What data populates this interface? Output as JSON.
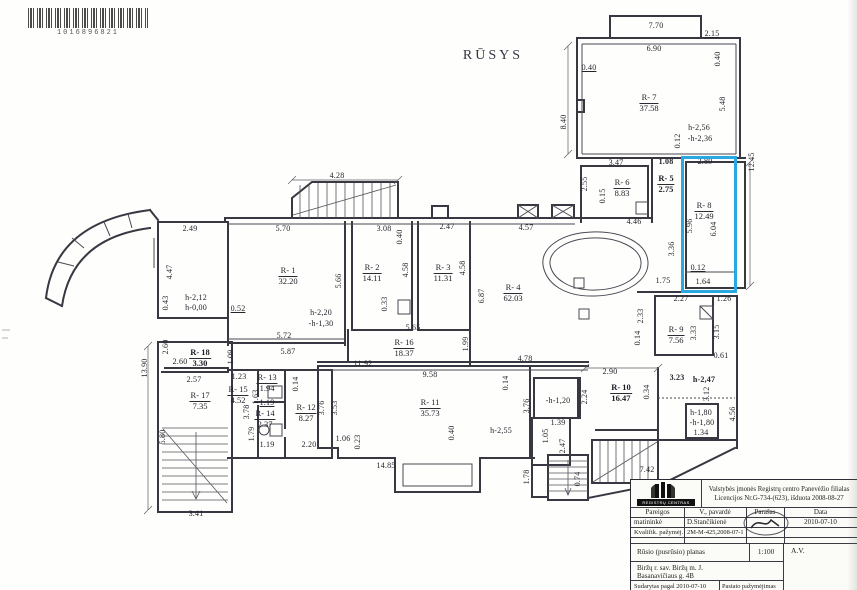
{
  "barcode": {
    "number": "1016896821"
  },
  "plan": {
    "title": "RŪSYS",
    "highlight_color": "#29a8e1",
    "rooms": [
      {
        "id": "R- 1",
        "area": "32.20",
        "x": 288,
        "y": 266
      },
      {
        "id": "R- 2",
        "area": "14.11",
        "x": 372,
        "y": 263
      },
      {
        "id": "R- 3",
        "area": "11.31",
        "x": 443,
        "y": 263
      },
      {
        "id": "R- 4",
        "area": "62.03",
        "x": 513,
        "y": 283
      },
      {
        "id": "R- 5",
        "area": "2.75",
        "x": 666,
        "y": 174,
        "b": 1
      },
      {
        "id": "R- 6",
        "area": "8.83",
        "x": 622,
        "y": 178
      },
      {
        "id": "R- 7",
        "area": "37.58",
        "x": 649,
        "y": 93
      },
      {
        "id": "R- 8",
        "area": "12.49",
        "x": 704,
        "y": 201
      },
      {
        "id": "R- 9",
        "area": "7.56",
        "x": 676,
        "y": 325
      },
      {
        "id": "R- 10",
        "area": "16.47",
        "x": 621,
        "y": 383,
        "b": 1
      },
      {
        "id": "R- 11",
        "area": "35.73",
        "x": 430,
        "y": 398
      },
      {
        "id": "R- 12",
        "area": "8.27",
        "x": 306,
        "y": 403
      },
      {
        "id": "R- 13",
        "area": "1.94",
        "x": 267,
        "y": 373
      },
      {
        "id": "R- 14",
        "area": "2.37",
        "x": 265,
        "y": 409
      },
      {
        "id": "R- 15",
        "area": "4.52",
        "x": 238,
        "y": 385
      },
      {
        "id": "R- 16",
        "area": "18.37",
        "x": 404,
        "y": 338
      },
      {
        "id": "R- 17",
        "area": "7.35",
        "x": 200,
        "y": 391
      },
      {
        "id": "R- 18",
        "area": "3.30",
        "x": 200,
        "y": 348,
        "b": 1
      }
    ],
    "dims": [
      {
        "t": "7.70",
        "x": 656,
        "y": 26
      },
      {
        "t": "6.90",
        "x": 654,
        "y": 49
      },
      {
        "t": "2.15",
        "x": 712,
        "y": 34,
        "u": 1
      },
      {
        "t": "0.40",
        "x": 718,
        "y": 59,
        "v": 1
      },
      {
        "t": "0.40",
        "x": 589,
        "y": 68,
        "u": 1
      },
      {
        "t": "5.48",
        "x": 723,
        "y": 104,
        "v": 1
      },
      {
        "t": "0.12",
        "x": 678,
        "y": 141,
        "v": 1
      },
      {
        "t": "h-2,56",
        "x": 699,
        "y": 128
      },
      {
        "t": "-h-2,36",
        "x": 700,
        "y": 139
      },
      {
        "t": "8.40",
        "x": 564,
        "y": 122,
        "v": 1
      },
      {
        "t": "12.45",
        "x": 752,
        "y": 162,
        "v": 1
      },
      {
        "t": "3.47",
        "x": 616,
        "y": 163
      },
      {
        "t": "1.08",
        "x": 666,
        "y": 162,
        "b": 1
      },
      {
        "t": "2.89",
        "x": 705,
        "y": 162
      },
      {
        "t": "2.55",
        "x": 585,
        "y": 184,
        "v": 1
      },
      {
        "t": "0.15",
        "x": 603,
        "y": 196,
        "v": 1
      },
      {
        "t": "4.46",
        "x": 634,
        "y": 222
      },
      {
        "t": "5.96",
        "x": 690,
        "y": 226,
        "v": 1
      },
      {
        "t": "6.04",
        "x": 714,
        "y": 229,
        "v": 1
      },
      {
        "t": "3.36",
        "x": 672,
        "y": 249,
        "v": 1
      },
      {
        "t": "0.12",
        "x": 698,
        "y": 268,
        "u": 1
      },
      {
        "t": "1.64",
        "x": 703,
        "y": 282
      },
      {
        "t": "1.75",
        "x": 663,
        "y": 281
      },
      {
        "t": "4.28",
        "x": 337,
        "y": 176
      },
      {
        "t": "4.57",
        "x": 526,
        "y": 228
      },
      {
        "t": "2.49",
        "x": 190,
        "y": 229
      },
      {
        "t": "5.70",
        "x": 283,
        "y": 229
      },
      {
        "t": "3.08",
        "x": 384,
        "y": 229
      },
      {
        "t": "0.40",
        "x": 400,
        "y": 237,
        "v": 1
      },
      {
        "t": "2.47",
        "x": 447,
        "y": 227
      },
      {
        "t": "4.47",
        "x": 170,
        "y": 272,
        "v": 1
      },
      {
        "t": "0.43",
        "x": 166,
        "y": 303,
        "v": 1
      },
      {
        "t": "h-2,12",
        "x": 196,
        "y": 298
      },
      {
        "t": "h-0,00",
        "x": 196,
        "y": 308
      },
      {
        "t": "5.66",
        "x": 339,
        "y": 281,
        "v": 1
      },
      {
        "t": "4.58",
        "x": 406,
        "y": 270,
        "v": 1
      },
      {
        "t": "0.33",
        "x": 385,
        "y": 304,
        "v": 1
      },
      {
        "t": "4.58",
        "x": 463,
        "y": 268,
        "v": 1
      },
      {
        "t": "6.87",
        "x": 482,
        "y": 296,
        "v": 1
      },
      {
        "t": "h-2,20",
        "x": 321,
        "y": 313
      },
      {
        "t": "-h-1,30",
        "x": 321,
        "y": 324
      },
      {
        "t": "0.52",
        "x": 238,
        "y": 309,
        "u": 1
      },
      {
        "t": "5.72",
        "x": 284,
        "y": 336
      },
      {
        "t": "5.87",
        "x": 288,
        "y": 352
      },
      {
        "t": "2.60",
        "x": 166,
        "y": 347,
        "v": 1
      },
      {
        "t": "2.60",
        "x": 180,
        "y": 362
      },
      {
        "t": "1.09",
        "x": 231,
        "y": 357,
        "v": 1
      },
      {
        "t": "13.90",
        "x": 145,
        "y": 368,
        "v": 1
      },
      {
        "t": "5.65",
        "x": 413,
        "y": 328
      },
      {
        "t": "1.99",
        "x": 466,
        "y": 344,
        "v": 1
      },
      {
        "t": "11.92",
        "x": 363,
        "y": 364
      },
      {
        "t": "4.78",
        "x": 525,
        "y": 359
      },
      {
        "t": "0.14",
        "x": 638,
        "y": 338,
        "v": 1
      },
      {
        "t": "2.33",
        "x": 641,
        "y": 316,
        "v": 1
      },
      {
        "t": "2.27",
        "x": 681,
        "y": 299
      },
      {
        "t": "1.26",
        "x": 724,
        "y": 299
      },
      {
        "t": "3.33",
        "x": 694,
        "y": 333,
        "v": 1
      },
      {
        "t": "3.15",
        "x": 717,
        "y": 332,
        "v": 1
      },
      {
        "t": "0.61",
        "x": 721,
        "y": 356
      },
      {
        "t": "2.57",
        "x": 194,
        "y": 380
      },
      {
        "t": "1.23",
        "x": 239,
        "y": 377
      },
      {
        "t": "5.80",
        "x": 163,
        "y": 437,
        "v": 1
      },
      {
        "t": "3.41",
        "x": 196,
        "y": 514
      },
      {
        "t": "3.78",
        "x": 247,
        "y": 412,
        "v": 1
      },
      {
        "t": "1.63",
        "x": 256,
        "y": 397,
        "v": 1
      },
      {
        "t": "1.19",
        "x": 267,
        "y": 403,
        "u": 1
      },
      {
        "t": "1.79",
        "x": 252,
        "y": 434,
        "v": 1
      },
      {
        "t": "1.19",
        "x": 267,
        "y": 445
      },
      {
        "t": "0.14",
        "x": 296,
        "y": 384,
        "v": 1
      },
      {
        "t": "3.76",
        "x": 322,
        "y": 408,
        "v": 1
      },
      {
        "t": "2.20",
        "x": 309,
        "y": 445
      },
      {
        "t": "3.53",
        "x": 335,
        "y": 408,
        "v": 1
      },
      {
        "t": "9.58",
        "x": 430,
        "y": 375
      },
      {
        "t": "0.14",
        "x": 506,
        "y": 383,
        "v": 1
      },
      {
        "t": "3.76",
        "x": 527,
        "y": 406,
        "v": 1
      },
      {
        "t": "1.06",
        "x": 343,
        "y": 439
      },
      {
        "t": "0.23",
        "x": 358,
        "y": 442,
        "v": 1
      },
      {
        "t": "0.40",
        "x": 452,
        "y": 433,
        "v": 1
      },
      {
        "t": "h-2,55",
        "x": 501,
        "y": 431
      },
      {
        "t": "14.85",
        "x": 386,
        "y": 466
      },
      {
        "t": "-h-1,20",
        "x": 558,
        "y": 401
      },
      {
        "t": "1.39",
        "x": 558,
        "y": 423
      },
      {
        "t": "1.05",
        "x": 546,
        "y": 436,
        "v": 1
      },
      {
        "t": "2.47",
        "x": 563,
        "y": 446,
        "v": 1
      },
      {
        "t": "2.24",
        "x": 585,
        "y": 397,
        "v": 1
      },
      {
        "t": "1.78",
        "x": 527,
        "y": 477,
        "v": 1
      },
      {
        "t": "0.74",
        "x": 578,
        "y": 479,
        "v": 1
      },
      {
        "t": "7.42",
        "x": 647,
        "y": 470
      },
      {
        "t": "2.90",
        "x": 610,
        "y": 372
      },
      {
        "t": "0.34",
        "x": 647,
        "y": 392,
        "v": 1
      },
      {
        "t": "3.23",
        "x": 677,
        "y": 378,
        "b": 1
      },
      {
        "t": "h-2,47",
        "x": 704,
        "y": 380,
        "b": 1
      },
      {
        "t": "3.12",
        "x": 707,
        "y": 394,
        "v": 1
      },
      {
        "t": "4.56",
        "x": 733,
        "y": 414,
        "v": 1
      },
      {
        "t": "h-1,80",
        "x": 701,
        "y": 413
      },
      {
        "t": "-h-1,80",
        "x": 702,
        "y": 423
      },
      {
        "t": "1.34",
        "x": 701,
        "y": 433
      }
    ]
  },
  "titleblock": {
    "logo_caption": "REGISTRŲ CENTRAS",
    "org_line1": "Valstybės įmonės Registrų centro Panevėžio filialas",
    "org_line2": "Licencijos Nr.G-734-(623), išduota 2008-08-27",
    "cols": [
      "Pareigos",
      "V., pavardė",
      "Parašas",
      "Data"
    ],
    "rows": [
      [
        "matininkė",
        "D.Stančikienė",
        "",
        "2010-07-10"
      ],
      [
        "Kvalifik. pažymėj.",
        "2M-M-425,2008-07-1",
        "",
        ""
      ]
    ],
    "plan_type": "Rūsio (pusrūsio) planas",
    "scale": "1:100",
    "stamp": "A.V.",
    "address_line1": "Biržų r. sav. Biržų m. J.",
    "address_line2": "Basanavičiaus g. 4B",
    "made_line1": "Sudarytas pagal  2010-07-10",
    "made_line2": "kadastrinių matavimų duomenis",
    "mark_line1": "Pastato pažymėjimas",
    "mark_line2": "plane    1B3b"
  }
}
